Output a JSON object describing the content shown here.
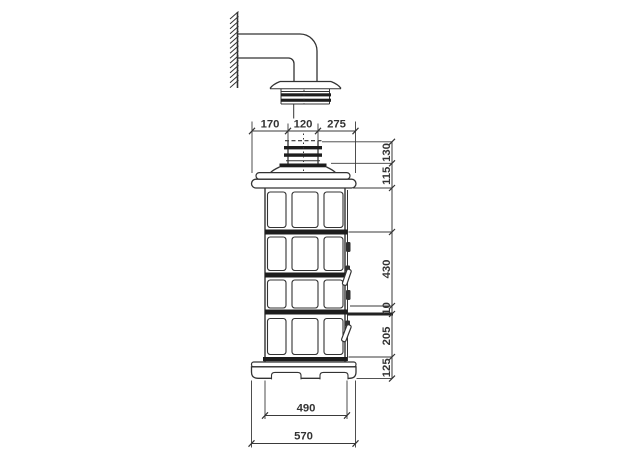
{
  "drawing": {
    "kind": "technical elevation drawing",
    "colors": {
      "ink": "#333333",
      "band": "#1d1d1d",
      "background": "#ffffff"
    }
  },
  "dimensions": {
    "top": [
      "170",
      "120",
      "275"
    ],
    "right_upper": [
      "130",
      "115"
    ],
    "right_lower": [
      "430",
      "10",
      "205",
      "125"
    ],
    "bottom": [
      "490",
      "570"
    ]
  }
}
